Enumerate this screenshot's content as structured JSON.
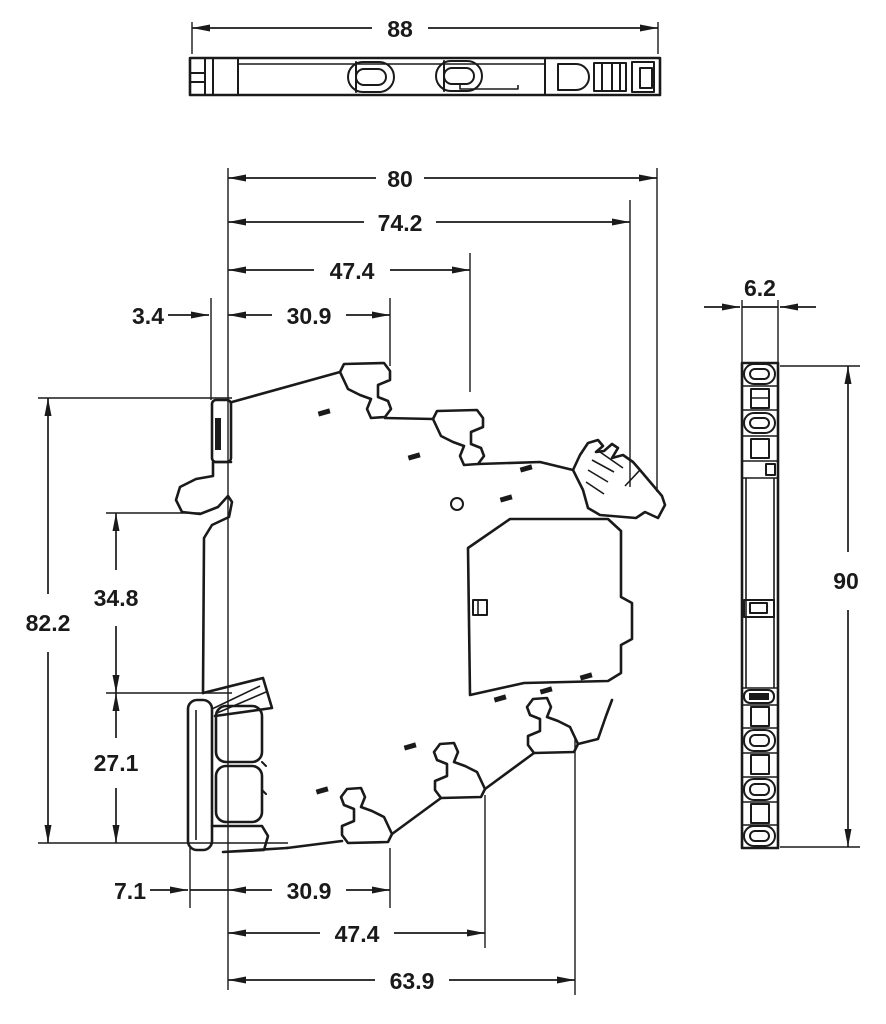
{
  "drawing": {
    "kind": "technical-dimension-drawing",
    "colors": {
      "line": "#1a1a1a",
      "background": "#ffffff"
    }
  },
  "dimensions": {
    "d88": "88",
    "d80": "80",
    "d74_2": "74.2",
    "d47_4_top": "47.4",
    "d30_9_top": "30.9",
    "d3_4": "3.4",
    "d82_2": "82.2",
    "d34_8": "34.8",
    "d27_1": "27.1",
    "d7_1": "7.1",
    "d30_9_bottom": "30.9",
    "d47_4_bottom": "47.4",
    "d63_9": "63.9",
    "d6_2": "6.2",
    "d90": "90"
  }
}
